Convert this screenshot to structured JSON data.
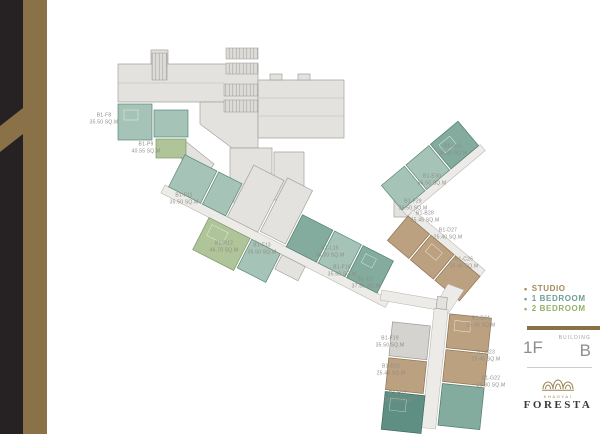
{
  "side_band": {
    "black": "#262223",
    "gold": "#8A7148"
  },
  "plan": {
    "label_color": "#8E8C88",
    "units": [
      {
        "id": "B1-F8",
        "area": "35.50 SQ.M",
        "x": 104,
        "y": 119
      },
      {
        "id": "B1-P9",
        "area": "40.55 SQ.M",
        "x": 146,
        "y": 148
      },
      {
        "id": "B1-F11",
        "area": "35.50 SQ.M",
        "x": 184,
        "y": 199
      },
      {
        "id": "B1-R12",
        "area": "46.70 SQ.M",
        "x": 224,
        "y": 247
      },
      {
        "id": "B1-F13",
        "area": "35.50 SQ.M",
        "x": 262,
        "y": 249
      },
      {
        "id": "B1-L15",
        "area": "38.30 SQ.M",
        "x": 330,
        "y": 252
      },
      {
        "id": "B1-F16",
        "area": "35.50 SQ.M",
        "x": 342,
        "y": 271
      },
      {
        "id": "B1-J17",
        "area": "37.55 SQ.M",
        "x": 366,
        "y": 283
      },
      {
        "id": "B1-H31",
        "area": "36.80 SQ.M",
        "x": 453,
        "y": 150
      },
      {
        "id": "B1-E30",
        "area": "35.50 SQ.M",
        "x": 432,
        "y": 180
      },
      {
        "id": "B1-F29",
        "area": "35.50 SQ.M",
        "x": 413,
        "y": 205
      },
      {
        "id": "B1-B28",
        "area": "25.45 SQ.M",
        "x": 425,
        "y": 217
      },
      {
        "id": "B1-D27",
        "area": "25.40 SQ.M",
        "x": 448,
        "y": 234
      },
      {
        "id": "B1-C26",
        "area": "25.40 SQ.M",
        "x": 464,
        "y": 263
      },
      {
        "id": "B1-B24",
        "area": "25.45 SQ.M",
        "x": 481,
        "y": 322
      },
      {
        "id": "B1-F19",
        "area": "35.50 SQ.M",
        "x": 390,
        "y": 342
      },
      {
        "id": "B1-A23",
        "area": "25.45 SQ.M",
        "x": 486,
        "y": 356
      },
      {
        "id": "B1-B20",
        "area": "25.45 SQ.M",
        "x": 391,
        "y": 370
      },
      {
        "id": "B1-G22",
        "area": "36.80 SQ.M",
        "x": 491,
        "y": 382
      },
      {
        "id": "B1-H21",
        "area": "36.80 SQ.M",
        "x": 398,
        "y": 397
      }
    ]
  },
  "legend": {
    "items": [
      {
        "label": "STUDIO",
        "color": "#A38A58"
      },
      {
        "label": "1 BEDROOM",
        "color": "#6F9E97"
      },
      {
        "label": "2 BEDROOM",
        "color": "#94B06C"
      }
    ]
  },
  "floor_info": {
    "building_caption": "BUILDING",
    "floor": "1F",
    "building": "B",
    "bar_color": "#8A7248"
  },
  "brand": {
    "location": "KHAOYAI",
    "name": "FORESTA",
    "ornament_color": "#9B8455"
  }
}
